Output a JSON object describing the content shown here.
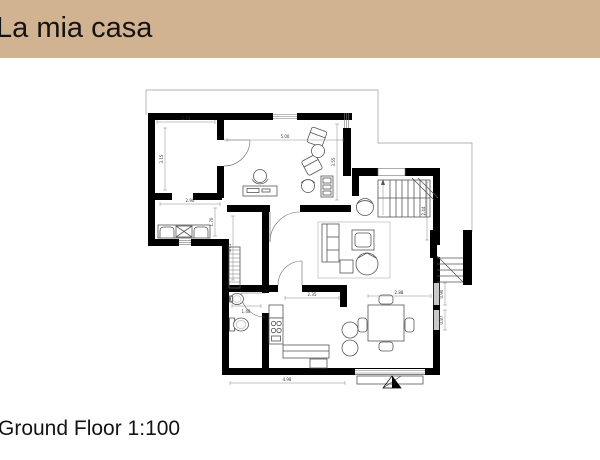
{
  "header": {
    "title": "La mia casa",
    "bg_color": "#d1b392",
    "text_color": "#141414"
  },
  "footer": {
    "caption": "Ground Floor 1:100"
  },
  "plan": {
    "scale": "1:100",
    "floor_name": "Ground Floor",
    "wall_color": "#000000",
    "window_color": "#c9c9c9",
    "outline_color": "#9a9a9a",
    "rooms": [
      "bedroom",
      "laundry",
      "study",
      "hallway",
      "bathroom",
      "kitchen",
      "dining",
      "living-room",
      "stair-hall",
      "entry-porch",
      "terrace"
    ],
    "dims": [
      {
        "label": "5.00"
      },
      {
        "label": "3.55"
      },
      {
        "label": "2.70"
      },
      {
        "label": "3.15"
      },
      {
        "label": "2.90"
      },
      {
        "label": "1.70"
      },
      {
        "label": "3.15"
      },
      {
        "label": "1.40"
      },
      {
        "label": "2.35"
      },
      {
        "label": "2.88"
      },
      {
        "label": "4.98"
      },
      {
        "label": "0.90"
      },
      {
        "label": "0.87"
      },
      {
        "label": "2.44"
      }
    ]
  }
}
